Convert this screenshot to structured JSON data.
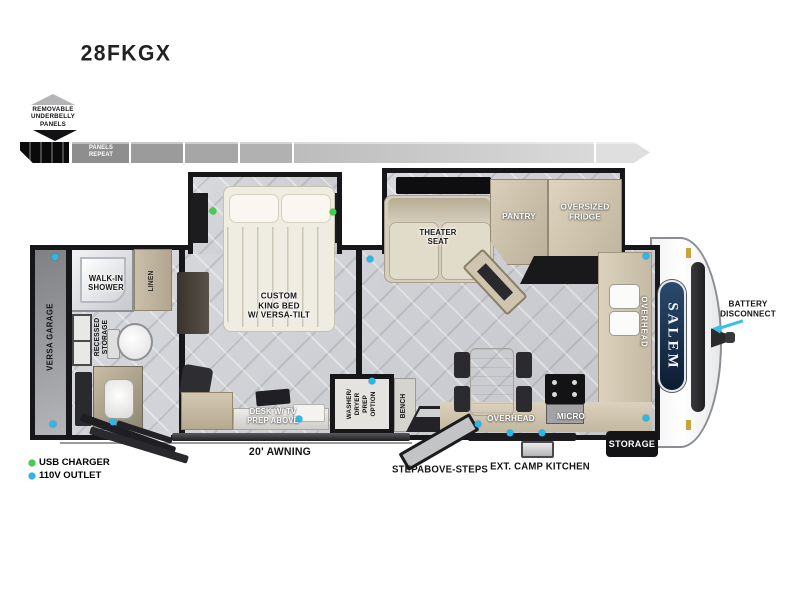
{
  "title": "28FKGX",
  "underbelly": {
    "label": "REMOVABLE\nUNDERBELLY\nPANELS",
    "panels_repeat": "PANELS\nREPEAT"
  },
  "legend": {
    "usb_label": "USB CHARGER",
    "outlet_label": "110V OUTLET",
    "usb_color": "#43cf4e",
    "outlet_color": "#2bb7e8"
  },
  "floorplan": {
    "versa_garage": "VERSA GARAGE",
    "walk_in_shower": "WALK-IN\nSHOWER",
    "linen": "LINEN",
    "recessed_storage": "RECESSED\nSTORAGE",
    "king_bed": "CUSTOM\nKING BED\nW/ VERSA-TILT",
    "desk": "DESK W/ TV\nPREP ABOVE",
    "washer_dryer": "WASHER/\nDRYER\nPREP\nOPTION",
    "bench": "BENCH",
    "theater_seat": "THEATER\nSEAT",
    "pantry": "PANTRY",
    "oversized_fridge": "OVERSIZED\nFRIDGE",
    "overhead_galley": "OVERHEAD",
    "overhead_front": "OVERHEAD",
    "micro": "MICRO"
  },
  "exterior": {
    "awning": "20' AWNING",
    "steps": "STEPABOVE-STEPS",
    "camp_kitchen": "EXT. CAMP KITCHEN",
    "storage": "STORAGE",
    "battery": "BATTERY\nDISCONNECT",
    "brand": "SALEM"
  },
  "outlets": {
    "usb": [
      [
        213,
        211
      ],
      [
        333,
        212
      ]
    ],
    "v110": [
      [
        55,
        257
      ],
      [
        53,
        424
      ],
      [
        113,
        422
      ],
      [
        370,
        259
      ],
      [
        299,
        419
      ],
      [
        372,
        381
      ],
      [
        478,
        424
      ],
      [
        510,
        433
      ],
      [
        542,
        433
      ],
      [
        646,
        256
      ],
      [
        646,
        418
      ]
    ]
  }
}
